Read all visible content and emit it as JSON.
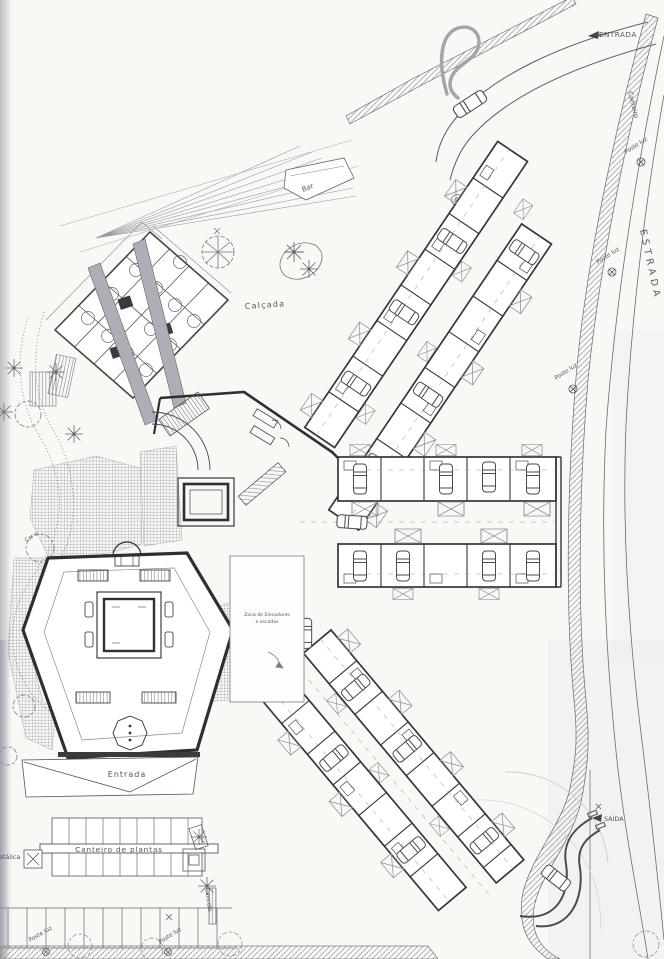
{
  "drawing": {
    "type": "architectural site plan (scanned)",
    "colors": {
      "paper": "#f8f8f5",
      "ink_heavy": "#2e2e33",
      "ink_light": "#77777c",
      "corridor_gray": "#b2acb6",
      "shadow_gray": "#9a9ba5",
      "tint_blue": "#e3e7ee"
    },
    "icons": {
      "car-icon": "top-view car (rounded rect with windshield lines)",
      "palm-icon": "✳",
      "tree-icon": "scalloped canopy circle",
      "lamp-icon": "⊗",
      "gate-box-icon": "⊠",
      "patio-x-icon": "rectangle with X diagonals",
      "arrow-icon": "►"
    }
  },
  "labels": {
    "entrada_top": {
      "text": "ENTRADA"
    },
    "canteiro_edge": {
      "text": "Canteiro"
    },
    "estrada": {
      "text": "ESTRADA"
    },
    "poste_luz_a": {
      "text": "Poste luz"
    },
    "poste_luz_b": {
      "text": "Poste luz"
    },
    "poste_luz_c": {
      "text": "Poste luz"
    },
    "bar": {
      "text": "Bar"
    },
    "calcada": {
      "text": "Calçada"
    },
    "elevators_line1": {
      "text": "Zona de Elevadores"
    },
    "elevators_line2": {
      "text": "e escadas"
    },
    "entrada_hex": {
      "text": "Entrada"
    },
    "canteiro_plantas": {
      "text": "Canteiro de plantas"
    },
    "metalica_partial": {
      "text": "etálica"
    },
    "cancelo": {
      "text": "Cancelo"
    },
    "poste_luz_d": {
      "text": "Poste luz"
    },
    "poste_luz_e": {
      "text": "Poste luz"
    },
    "saida": {
      "text": "SAÍDA"
    },
    "car_o": {
      "text": "Car o"
    }
  }
}
